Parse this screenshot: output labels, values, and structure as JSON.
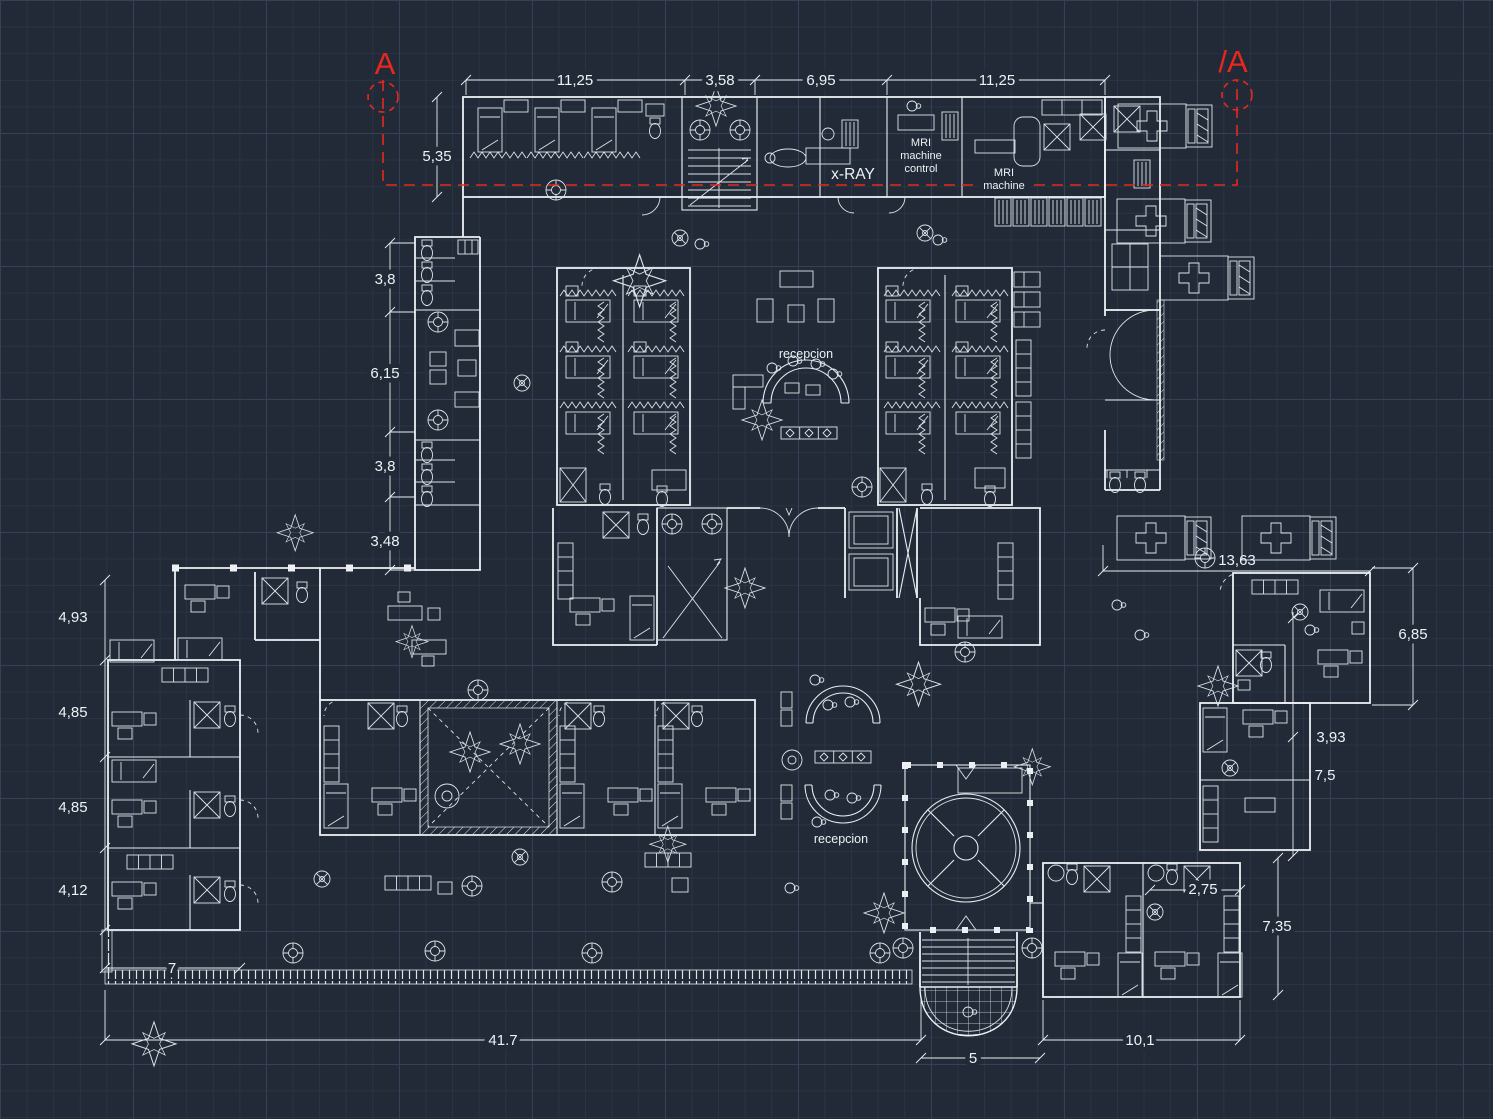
{
  "canvas": {
    "bg": "#212a36",
    "grid_minor": "#2a3444",
    "grid_major": "#344156",
    "ink": "#edf1f5",
    "accent_red": "#e8281e"
  },
  "section_markers": {
    "left": "A",
    "right": "/A"
  },
  "labels": {
    "xray": "x-RAY",
    "mri_control": [
      "MRI",
      "machine",
      "control"
    ],
    "mri_machine": [
      "MRI",
      "machine"
    ],
    "reception_upper": "recepcion",
    "reception_lower": "recepcion"
  },
  "dimensions": {
    "top": [
      "11,25",
      "3,58",
      "6,95",
      "11,25"
    ],
    "upper_left": "5,35",
    "left": [
      "3,8",
      "6,15",
      "3,8",
      "3,48"
    ],
    "far_left": [
      "4,93",
      "4,85",
      "4,85",
      "4,12"
    ],
    "porch": "7",
    "bottom_total": "41.7",
    "pool": "5",
    "bottom_right": "10,1",
    "right_top": "13,63",
    "right_room": "6,85",
    "right_mid_a": "3,93",
    "right_mid_b": "7,5",
    "br_inner": "2,75",
    "br_height": "7,35"
  }
}
